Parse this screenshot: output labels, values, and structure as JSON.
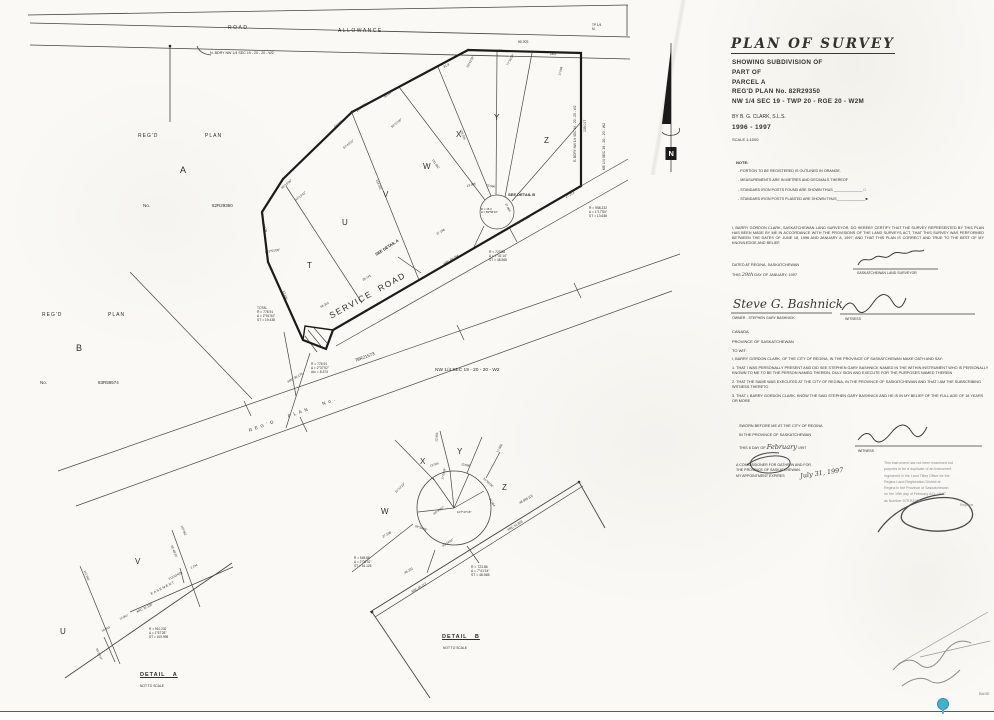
{
  "colors": {
    "ink": "#34322e",
    "paper": "#faf9f5",
    "stamp_gray": "#8b8b8b",
    "pin_teal": "#41b2cf"
  },
  "title_block": {
    "title": "PLAN  OF  SURVEY",
    "lines": [
      "SHOWING SUBDIVISION OF",
      "PART OF",
      "PARCEL A",
      "REG'D PLAN No. 82R29350",
      "NW 1/4 SEC 19 - TWP 20 - RGE 20 - W2M"
    ],
    "by_line": "BY     B. G. CLARK, S.L.S.",
    "years": "1996 - 1997",
    "scale": "SCALE   1:1000"
  },
  "notes": {
    "heading": "NOTE:",
    "items": [
      "- PORTION TO BE REGISTERED IS OUTLINED IN ORANGE.",
      "- MEASUREMENTS ARE IN METRES AND DECIMALS THEREOF",
      "- STANDARD IRON POSTS FOUND ARE SHOWN THUS  ______________ □",
      "- STANDARD IRON POSTS PLANTED ARE SHOWN THUS______________■"
    ]
  },
  "certification": {
    "body": "I, BARRY GORDON CLARK, SASKATCHEWAN LAND SURVEYOR, DO HEREBY CERTIFY THAT THE SURVEY REPRESENTED BY THIS PLAN HAS BEEN MADE BY ME IN ACCORDANCE WITH THE PROVISIONS OF THE LAND SURVEYS ACT, THAT THIS SURVEY WAS PERFORMED BETWEEN THE DATES OF JUNE 18, 1996 AND JANUARY 8, 1997, AND THAT THIS PLAN IS CORRECT AND TRUE TO THE BEST OF MY KNOWLEDGE AND BELIEF.",
    "dated": "DATED AT REGINA, SASKATCHEWAN",
    "dated_this": "THIS ",
    "dated_day": "29th",
    "dated_rest": " DAY OF JANUARY, 1997",
    "surveyor_title": "SASKATCHEWAN LAND SURVEYOR",
    "owner_sig": "Steve G. Bashnick",
    "owner_label": "OWNER   -   STEPHEN GARY BASHNICK",
    "witness_label": "WITNESS"
  },
  "jurisdiction": {
    "lines": [
      "CANADA",
      "PROVINCE OF SASKATCHEWAN",
      "TO WIT:"
    ]
  },
  "affidavit": {
    "intro": "I, BARRY GORDON CLARK, OF THE CITY OF REGINA, IN THE PROVINCE OF SASKATCHEWAN MAKE OATH AND SAY:",
    "items": [
      "1.  THAT I WAS PERSONALLY PRESENT AND DID SEE STEPHEN GARY BASHNICK NAMED IN THE WITHIN INSTRUMENT WHO IS PERSONALLY KNOWN TO ME TO BE THE PERSON NAMED THEREIN, DULY SIGN AND EXECUTE FOR THE PURPOSES NAMED THEREIN",
      "2.  THAT THE SAME WAS EXECUTED AT THE CITY OF REGINA, IN THE PROVINCE OF SASKATCHEWAN AND THAT I AM THE SUBSCRIBING WITNESS THERETO",
      "3.  THAT I, BARRY GORDON CLARK, KNOW THE SAID STEPHEN GARY BASHNICK AND HE IS IN MY BELIEF OF THE FULL AGE OF 18 YEARS OR MORE"
    ],
    "sworn1": "SWORN BEFORE ME AT THE CITY OF REGINA",
    "sworn2": "IN THE PROVINCE OF SASKATCHEWAN",
    "sworn_this": "THIS ",
    "sworn_day": "6",
    "sworn_of": " DAY OF ",
    "sworn_month": "February",
    "sworn_year": " 1997",
    "witness_label": "WITNESS",
    "commissioner_lines": [
      "A COMMISSIONER FOR OATHS IN AND FOR",
      "THE PROVINCE OF SASKATCHEWAN.",
      "MY APPOINTMENT EXPIRES"
    ],
    "expiry": "July 31, 1997"
  },
  "stamp": {
    "lines": [
      "This instrument has not been examined but",
      "purports to be a duplicate of an instrument",
      "registered in the Land Titles Office for the",
      "Regina Land Registration District at",
      "Regina in the Province of Saskatchewan",
      "on the 19th day of February A.D. 19 97",
      "as Number 97R B1305"
    ],
    "registrar": "Registrar"
  },
  "footer": {
    "base_label": "BASE"
  },
  "plan": {
    "north": "N",
    "labels": [
      {
        "t": "ROAD",
        "x": 228,
        "y": 25,
        "s": 5,
        "ls": 1.5,
        "n": "road-label"
      },
      {
        "t": "ALLOWANCE",
        "x": 338,
        "y": 28,
        "s": 5,
        "ls": 1.5,
        "n": "allowance-label"
      },
      {
        "t": "TP 1/4\nM",
        "x": 592,
        "y": 24,
        "s": 3.2
      },
      {
        "t": "N. BDRY NW 1/4 SEC 19 - 20 - 20 - W2",
        "x": 210,
        "y": 51,
        "s": 3.6,
        "n": "north-boundary-label"
      },
      {
        "t": "REG'D",
        "x": 138,
        "y": 133,
        "s": 5,
        "ls": 1
      },
      {
        "t": "PLAN",
        "x": 205,
        "y": 133,
        "s": 5,
        "ls": 1
      },
      {
        "t": "A",
        "x": 180,
        "y": 165,
        "s": 9,
        "n": "parcel-a-label"
      },
      {
        "t": "No.",
        "x": 143,
        "y": 203,
        "s": 4.5
      },
      {
        "t": "82R29350",
        "x": 212,
        "y": 203,
        "s": 4.5,
        "n": "parcel-a-plan-number"
      },
      {
        "t": "REG'D",
        "x": 42,
        "y": 312,
        "s": 5,
        "ls": 1
      },
      {
        "t": "PLAN",
        "x": 108,
        "y": 312,
        "s": 5,
        "ls": 1
      },
      {
        "t": "B",
        "x": 76,
        "y": 343,
        "s": 9,
        "n": "parcel-b-label"
      },
      {
        "t": "No.",
        "x": 40,
        "y": 380,
        "s": 4.5
      },
      {
        "t": "83R59574",
        "x": 98,
        "y": 380,
        "s": 4.5,
        "n": "parcel-b-plan-number"
      },
      {
        "t": "T",
        "x": 307,
        "y": 261,
        "s": 8,
        "n": "lot-label-t"
      },
      {
        "t": "U",
        "x": 342,
        "y": 218,
        "s": 8,
        "n": "lot-label-u"
      },
      {
        "t": "V",
        "x": 383,
        "y": 190,
        "s": 8,
        "n": "lot-label-v"
      },
      {
        "t": "W",
        "x": 423,
        "y": 162,
        "s": 8,
        "n": "lot-label-w"
      },
      {
        "t": "X",
        "x": 456,
        "y": 130,
        "s": 8,
        "n": "lot-label-x"
      },
      {
        "t": "Y",
        "x": 494,
        "y": 113,
        "s": 8,
        "n": "lot-label-y"
      },
      {
        "t": "Z",
        "x": 544,
        "y": 136,
        "s": 8,
        "n": "lot-label-z"
      },
      {
        "t": "SERVICE  ROAD",
        "x": 330,
        "y": 311,
        "s": 8.5,
        "r": -29,
        "ls": 1.5,
        "n": "service-road-label"
      },
      {
        "t": "SEE DETAIL B",
        "x": 508,
        "y": 193,
        "s": 4,
        "w": "bold",
        "n": "see-detail-b"
      },
      {
        "t": "SEE DETAIL A",
        "x": 376,
        "y": 253,
        "s": 4,
        "r": -33,
        "w": "bold",
        "n": "see-detail-a"
      },
      {
        "t": "REG'D   PLAN   No.",
        "x": 249,
        "y": 428,
        "s": 4.5,
        "r": -20,
        "ls": 3,
        "n": "regd-plan-road-label"
      },
      {
        "t": "78R21573",
        "x": 355,
        "y": 358,
        "s": 4.5,
        "r": -20,
        "n": "plan-78r21573"
      },
      {
        "t": "NW 1/4 SEC 19 - 20 - 20 - W2",
        "x": 435,
        "y": 368,
        "s": 4.8,
        "n": "nw-quarter-label"
      },
      {
        "t": "E. BDRY NW 1/4 SEC 19 - 20 - 20 - W2",
        "x": 576,
        "y": 160,
        "s": 3.2,
        "r": -90,
        "n": "east-boundary-label"
      },
      {
        "t": "139.017",
        "x": 585,
        "y": 130,
        "s": 3.4,
        "r": -90
      },
      {
        "t": "NE 1/4 SEC 19 - 20 - 20 - W2",
        "x": 604,
        "y": 168,
        "s": 3.6,
        "r": -90,
        "n": "ne-quarter-label"
      },
      {
        "t": "31.8",
        "x": 444,
        "y": 66,
        "s": 3.2,
        "r": -28
      },
      {
        "t": "91.803",
        "x": 492,
        "y": 49,
        "s": 3.4,
        "r": -2
      },
      {
        "t": "80.303",
        "x": 518,
        "y": 40,
        "s": 3.4,
        "r": -2
      },
      {
        "t": "28.0",
        "x": 550,
        "y": 53,
        "s": 3.2
      },
      {
        "t": "30°43'32\"",
        "x": 468,
        "y": 66,
        "s": 3,
        "r": -62
      },
      {
        "t": "77°36'30\"",
        "x": 508,
        "y": 64,
        "s": 3,
        "r": -62
      },
      {
        "t": "17.088",
        "x": 560,
        "y": 74,
        "s": 3,
        "r": -75
      },
      {
        "t": "45.094",
        "x": 385,
        "y": 96,
        "s": 3.2,
        "r": -39
      },
      {
        "t": "145.281",
        "x": 357,
        "y": 110,
        "s": 3.2,
        "r": -39
      },
      {
        "t": "43.096",
        "x": 335,
        "y": 126,
        "s": 3.2,
        "r": -39
      },
      {
        "t": "56°37'00\"",
        "x": 392,
        "y": 126,
        "s": 3,
        "r": -39
      },
      {
        "t": "63°43'32\"",
        "x": 344,
        "y": 147,
        "s": 3,
        "r": -39
      },
      {
        "t": "43°13'42\"",
        "x": 296,
        "y": 199,
        "s": 3,
        "r": -39
      },
      {
        "t": "98°16'08\"",
        "x": 282,
        "y": 187,
        "s": 3,
        "r": -39
      },
      {
        "t": "82.778",
        "x": 262,
        "y": 221,
        "s": 3.2,
        "r": 70
      },
      {
        "t": "131°51'08\"",
        "x": 265,
        "y": 251,
        "s": 3.2,
        "r": -8
      },
      {
        "t": "13.136",
        "x": 283,
        "y": 289,
        "s": 3,
        "r": 72
      },
      {
        "t": "134.262",
        "x": 376,
        "y": 178,
        "s": 3,
        "r": 68
      },
      {
        "t": "131.962",
        "x": 432,
        "y": 158,
        "s": 3,
        "r": 55
      },
      {
        "t": "128.205",
        "x": 460,
        "y": 128,
        "s": 3,
        "r": 68
      },
      {
        "t": "13.005",
        "x": 467,
        "y": 185,
        "s": 3,
        "r": -15
      },
      {
        "t": "13.696",
        "x": 486,
        "y": 184,
        "s": 3,
        "r": 10
      },
      {
        "t": "27.084",
        "x": 505,
        "y": 202,
        "s": 3,
        "r": 62
      },
      {
        "t": "27.198",
        "x": 437,
        "y": 233,
        "s": 3,
        "r": -30
      },
      {
        "t": "R = 15.0\nΔ = 89°58'16\"",
        "x": 481,
        "y": 208,
        "s": 2.8
      },
      {
        "t": "ARC 51.803",
        "x": 515,
        "y": 224,
        "s": 3.2,
        "r": -30
      },
      {
        "t": "27.213",
        "x": 566,
        "y": 196,
        "s": 3.2,
        "r": -30
      },
      {
        "t": "ARC 46.294",
        "x": 444,
        "y": 263,
        "s": 3.2,
        "r": -30
      },
      {
        "t": "29.743",
        "x": 363,
        "y": 279,
        "s": 3,
        "r": -30
      },
      {
        "t": "56.314",
        "x": 321,
        "y": 306,
        "s": 3,
        "r": -30
      },
      {
        "t": "R = 958.232\nΔ = 1°17'50\"\nST = 13.638",
        "x": 589,
        "y": 207,
        "s": 3.3
      },
      {
        "t": "R = 723.86\nΔ = 7°41'14\"\nST = 48.565",
        "x": 489,
        "y": 251,
        "s": 3.3
      },
      {
        "t": "TOTAL\nR = 778.91\nΔ = 2°51'54\"\nST = 19.438",
        "x": 257,
        "y": 307,
        "s": 3.3
      },
      {
        "t": "R = 778.91\nΔ = 2°37'02\"\nArc = 8.373",
        "x": 311,
        "y": 363,
        "s": 3.3
      },
      {
        "t": "ARC 36.175",
        "x": 288,
        "y": 381,
        "s": 3.2,
        "r": -30
      },
      {
        "t": "N",
        "x": 668.5,
        "y": 149,
        "s": 7.5,
        "w": "bold",
        "c": "#ffffff",
        "n": "north-label"
      }
    ]
  },
  "detail_a": {
    "labels": [
      {
        "t": "U",
        "x": 60,
        "y": 627,
        "s": 8,
        "n": "detail-a-lot-u"
      },
      {
        "t": "V",
        "x": 135,
        "y": 557,
        "s": 8,
        "n": "detail-a-lot-v"
      },
      {
        "t": "112.043",
        "x": 84,
        "y": 569,
        "s": 3,
        "r": 68
      },
      {
        "t": "EASEMENT",
        "x": 151,
        "y": 592,
        "s": 3.4,
        "r": -27,
        "ls": 1,
        "n": "easement-label"
      },
      {
        "t": "ARC 21.130",
        "x": 137,
        "y": 611,
        "s": 3.2,
        "r": -27
      },
      {
        "t": "213.634(D)",
        "x": 169,
        "y": 578,
        "s": 3,
        "r": -27
      },
      {
        "t": "10.063",
        "x": 102,
        "y": 630,
        "s": 3,
        "r": -27
      },
      {
        "t": "12.967",
        "x": 120,
        "y": 618,
        "s": 3,
        "r": -27
      },
      {
        "t": "R = 910.232\nΔ = 1°57'28\"\nST = 109.998",
        "x": 149,
        "y": 628,
        "s": 3.2
      },
      {
        "t": "55°48'20\"",
        "x": 171,
        "y": 544,
        "s": 3,
        "r": 68
      },
      {
        "t": "2.234",
        "x": 191,
        "y": 567,
        "s": 3,
        "r": -27
      },
      {
        "t": "110.062",
        "x": 181,
        "y": 524,
        "s": 3,
        "r": 68
      },
      {
        "t": "50°20'47\"",
        "x": 96,
        "y": 647,
        "s": 3,
        "r": 68
      },
      {
        "t": "DETAIL   A",
        "x": 140,
        "y": 672,
        "s": 5.5,
        "w": "bold",
        "u": 1,
        "ls": 1,
        "n": "detail-a-title"
      },
      {
        "t": "NOT TO SCALE",
        "x": 140,
        "y": 685,
        "s": 3.3,
        "n": "detail-a-scale"
      }
    ]
  },
  "detail_b": {
    "labels": [
      {
        "t": "W",
        "x": 381,
        "y": 507,
        "s": 8,
        "n": "detail-b-lot-w"
      },
      {
        "t": "X",
        "x": 420,
        "y": 457,
        "s": 8,
        "n": "detail-b-lot-x"
      },
      {
        "t": "Y",
        "x": 457,
        "y": 447,
        "s": 8,
        "n": "detail-b-lot-y"
      },
      {
        "t": "Z",
        "x": 502,
        "y": 483,
        "s": 8,
        "n": "detail-b-lot-z"
      },
      {
        "t": "13.005",
        "x": 430,
        "y": 465,
        "s": 3,
        "r": -18
      },
      {
        "t": "13.696",
        "x": 461,
        "y": 463,
        "s": 3,
        "r": 12
      },
      {
        "t": "17°00'08\"",
        "x": 443,
        "y": 478,
        "s": 2.8,
        "r": -78
      },
      {
        "t": "21°12'23\"",
        "x": 396,
        "y": 491,
        "s": 3,
        "r": -45
      },
      {
        "t": "69°56'06\"",
        "x": 415,
        "y": 525,
        "s": 3,
        "r": 18
      },
      {
        "t": "49°25'07\"",
        "x": 434,
        "y": 513,
        "s": 3,
        "r": -35
      },
      {
        "t": "107°47'16\"",
        "x": 457,
        "y": 511,
        "s": 3
      },
      {
        "t": "63°34'02\"",
        "x": 443,
        "y": 545,
        "s": 3,
        "r": -33
      },
      {
        "t": "31°55'08\"",
        "x": 483,
        "y": 477,
        "s": 3,
        "r": 42
      },
      {
        "t": "27.084",
        "x": 489,
        "y": 497,
        "s": 3,
        "r": 58
      },
      {
        "t": "27.198",
        "x": 383,
        "y": 536,
        "s": 3.2,
        "r": -31
      },
      {
        "t": "48.231",
        "x": 405,
        "y": 572,
        "s": 3.2,
        "r": -31
      },
      {
        "t": "ARC 45.117",
        "x": 412,
        "y": 591,
        "s": 3.2,
        "r": -31
      },
      {
        "t": "ARC 51.803",
        "x": 508,
        "y": 529,
        "s": 3.2,
        "r": -31
      },
      {
        "t": "48.965 (D)",
        "x": 520,
        "y": 502,
        "s": 3.2,
        "r": -31
      },
      {
        "t": "12.956",
        "x": 437,
        "y": 440,
        "s": 3,
        "r": -85
      },
      {
        "t": "17.088",
        "x": 498,
        "y": 451,
        "s": 3,
        "r": -62
      },
      {
        "t": "R = 545.88\nΔ = 2°08'31\"\nST = 16.125",
        "x": 354,
        "y": 557,
        "s": 3.2
      },
      {
        "t": "R = 723.86\nΔ = 7°41'14\"\nST = 48.565",
        "x": 471,
        "y": 565,
        "s": 3.4
      },
      {
        "t": "DETAIL   B",
        "x": 442,
        "y": 634,
        "s": 5.5,
        "w": "bold",
        "u": 1,
        "ls": 1,
        "n": "detail-b-title"
      },
      {
        "t": "NOT TO SCALE",
        "x": 443,
        "y": 647,
        "s": 3.3,
        "n": "detail-b-scale"
      }
    ]
  }
}
